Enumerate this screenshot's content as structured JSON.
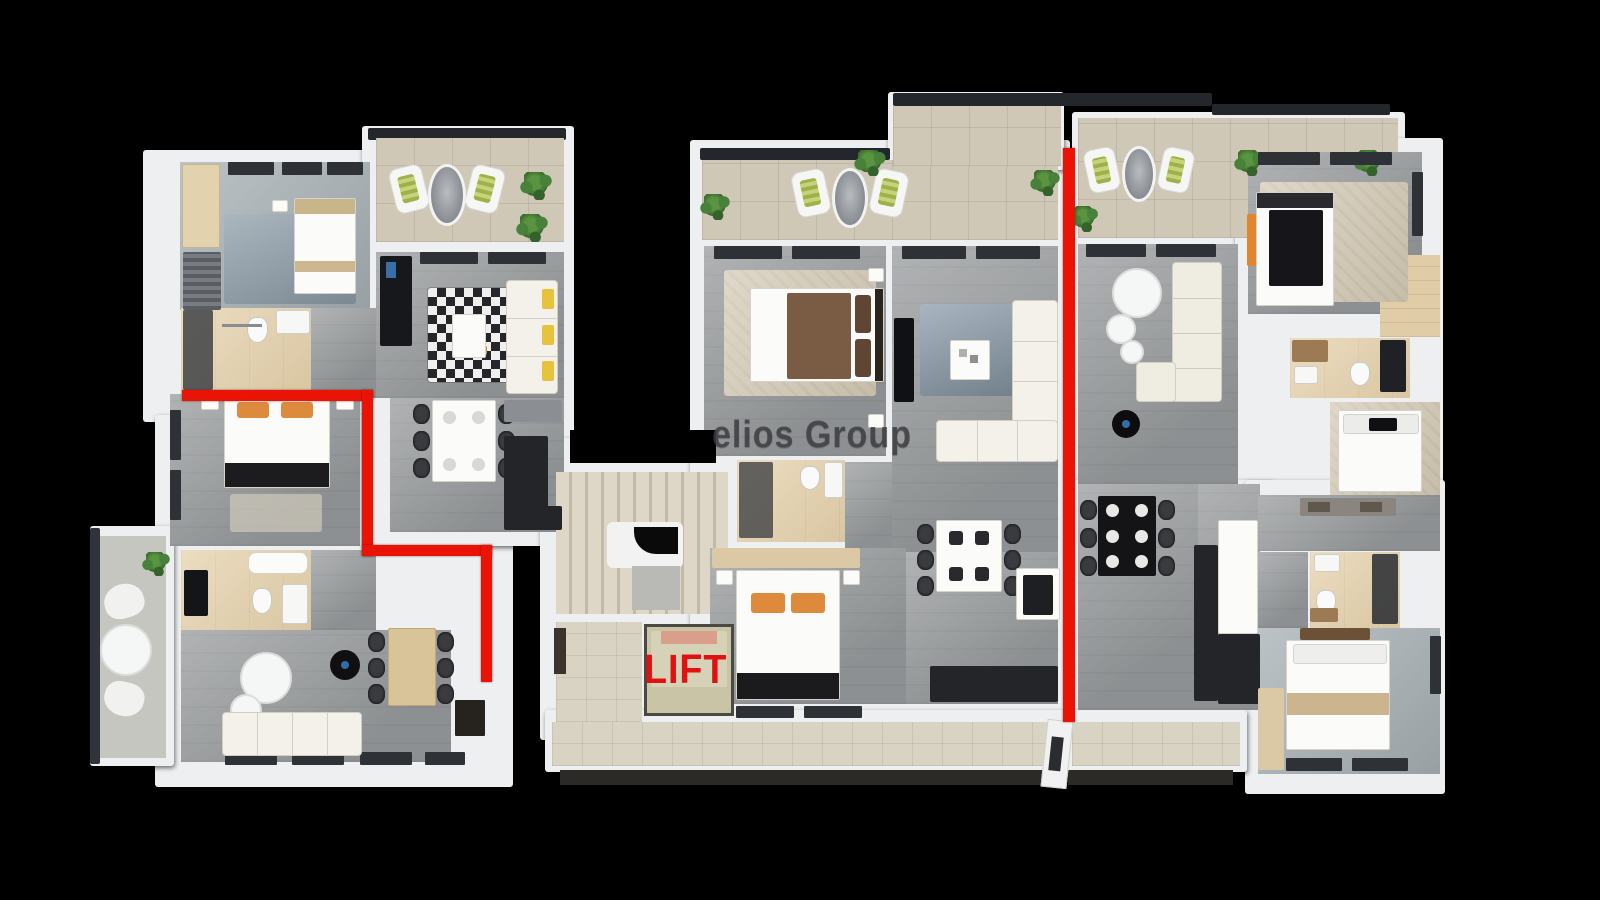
{
  "watermark": {
    "text": "elios Group"
  },
  "lift": {
    "label": "LIFT"
  },
  "colors": {
    "background": "#000000",
    "boundary_red": "#ea1406",
    "lift_red": "#e21111",
    "wall_white": "#edeff1",
    "floor_gray": "#9da0a2",
    "floor_tan": "#e6d2ac",
    "balcony_tile": "#cfc8b6",
    "rug_blue": "#8c9dab",
    "watermark_gray": "#3e3e42"
  }
}
